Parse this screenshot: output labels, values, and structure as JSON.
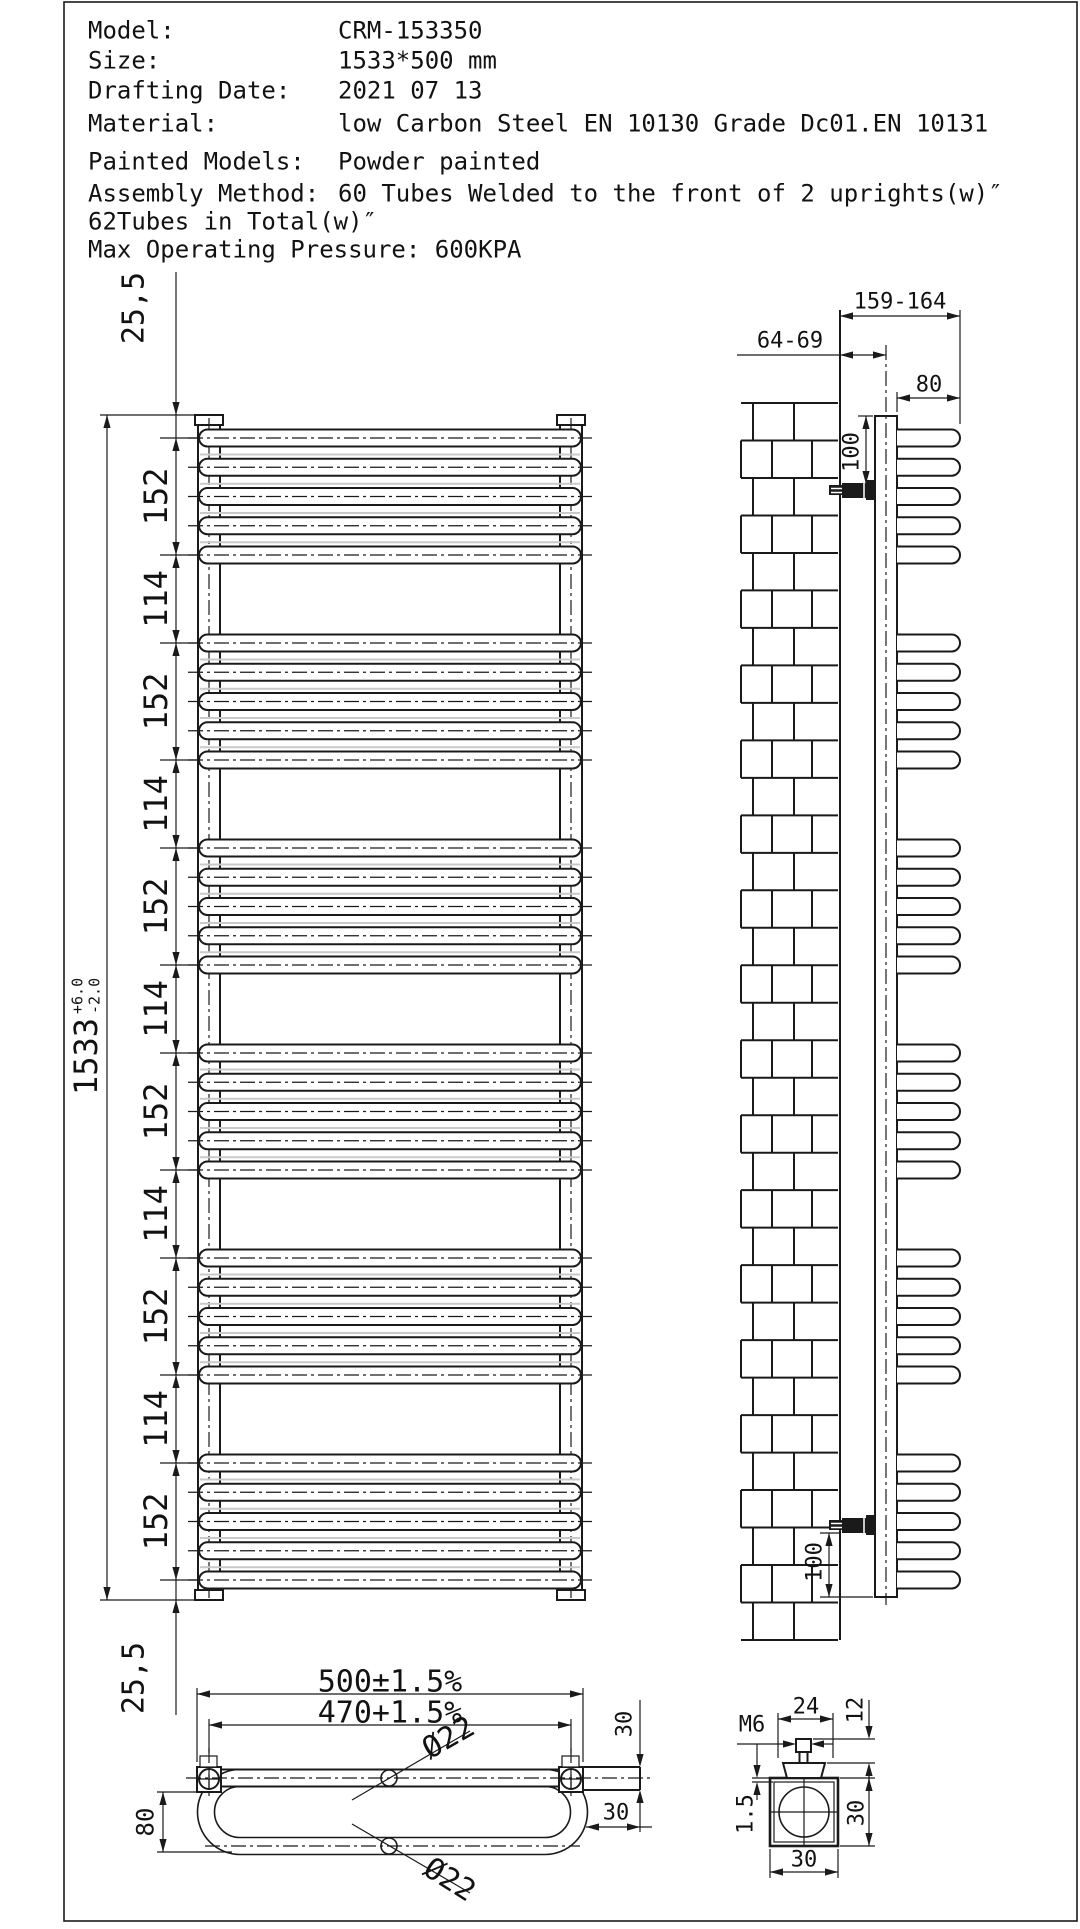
{
  "sheet": {
    "background": "#ffffff",
    "line_color": "#1a1a1a"
  },
  "title_block": {
    "rows": [
      {
        "label": "Model:",
        "value": "CRM-153350"
      },
      {
        "label": "Size:",
        "value": "1533*500 mm"
      },
      {
        "label": "Drafting Date:",
        "value": "2021 07 13"
      },
      {
        "label": "Material:",
        "value": "low Carbon Steel  EN 10130 Grade Dc01.EN 10131"
      },
      {
        "label": "Painted Models:",
        "value": "Powder painted"
      },
      {
        "label": "Assembly Method:",
        "value": "60 Tubes Welded to the front of 2 uprights(w)″"
      },
      {
        "label": "62Tubes in Total(w)″",
        "value": ""
      },
      {
        "label": "Max Operating Pressure: 600KPA",
        "value": ""
      }
    ]
  },
  "front_view": {
    "overall": {
      "nominal": "1533",
      "tol_plus": "+6.0",
      "tol_minus": "-2.0"
    },
    "chain": [
      "25,5",
      "152",
      "114",
      "152",
      "114",
      "152",
      "114",
      "152",
      "114",
      "152",
      "114",
      "152",
      "25,5"
    ],
    "tube_groups": 6,
    "tubes_per_group": 5
  },
  "side_view": {
    "dims": {
      "bracket_range": "159-164",
      "wall_clearance": "64-69",
      "tube_depth": "80",
      "top_bracket_offset": "100",
      "bottom_bracket_offset": "100"
    }
  },
  "plan_view": {
    "dims": {
      "overall_width": "500±1.5%",
      "upright_centres": "470+1.5%",
      "tube_diameter_rear": "Ø22",
      "tube_diameter_front": "Ø22",
      "tube_drop": "80",
      "bracket_height": "30",
      "bracket_width": "30"
    }
  },
  "bracket_detail": {
    "dims": {
      "flange_width": "24",
      "stud_length": "12",
      "thread": "M6",
      "plate_thickness": "1.5",
      "body_height": "30",
      "body_width": "30"
    }
  }
}
